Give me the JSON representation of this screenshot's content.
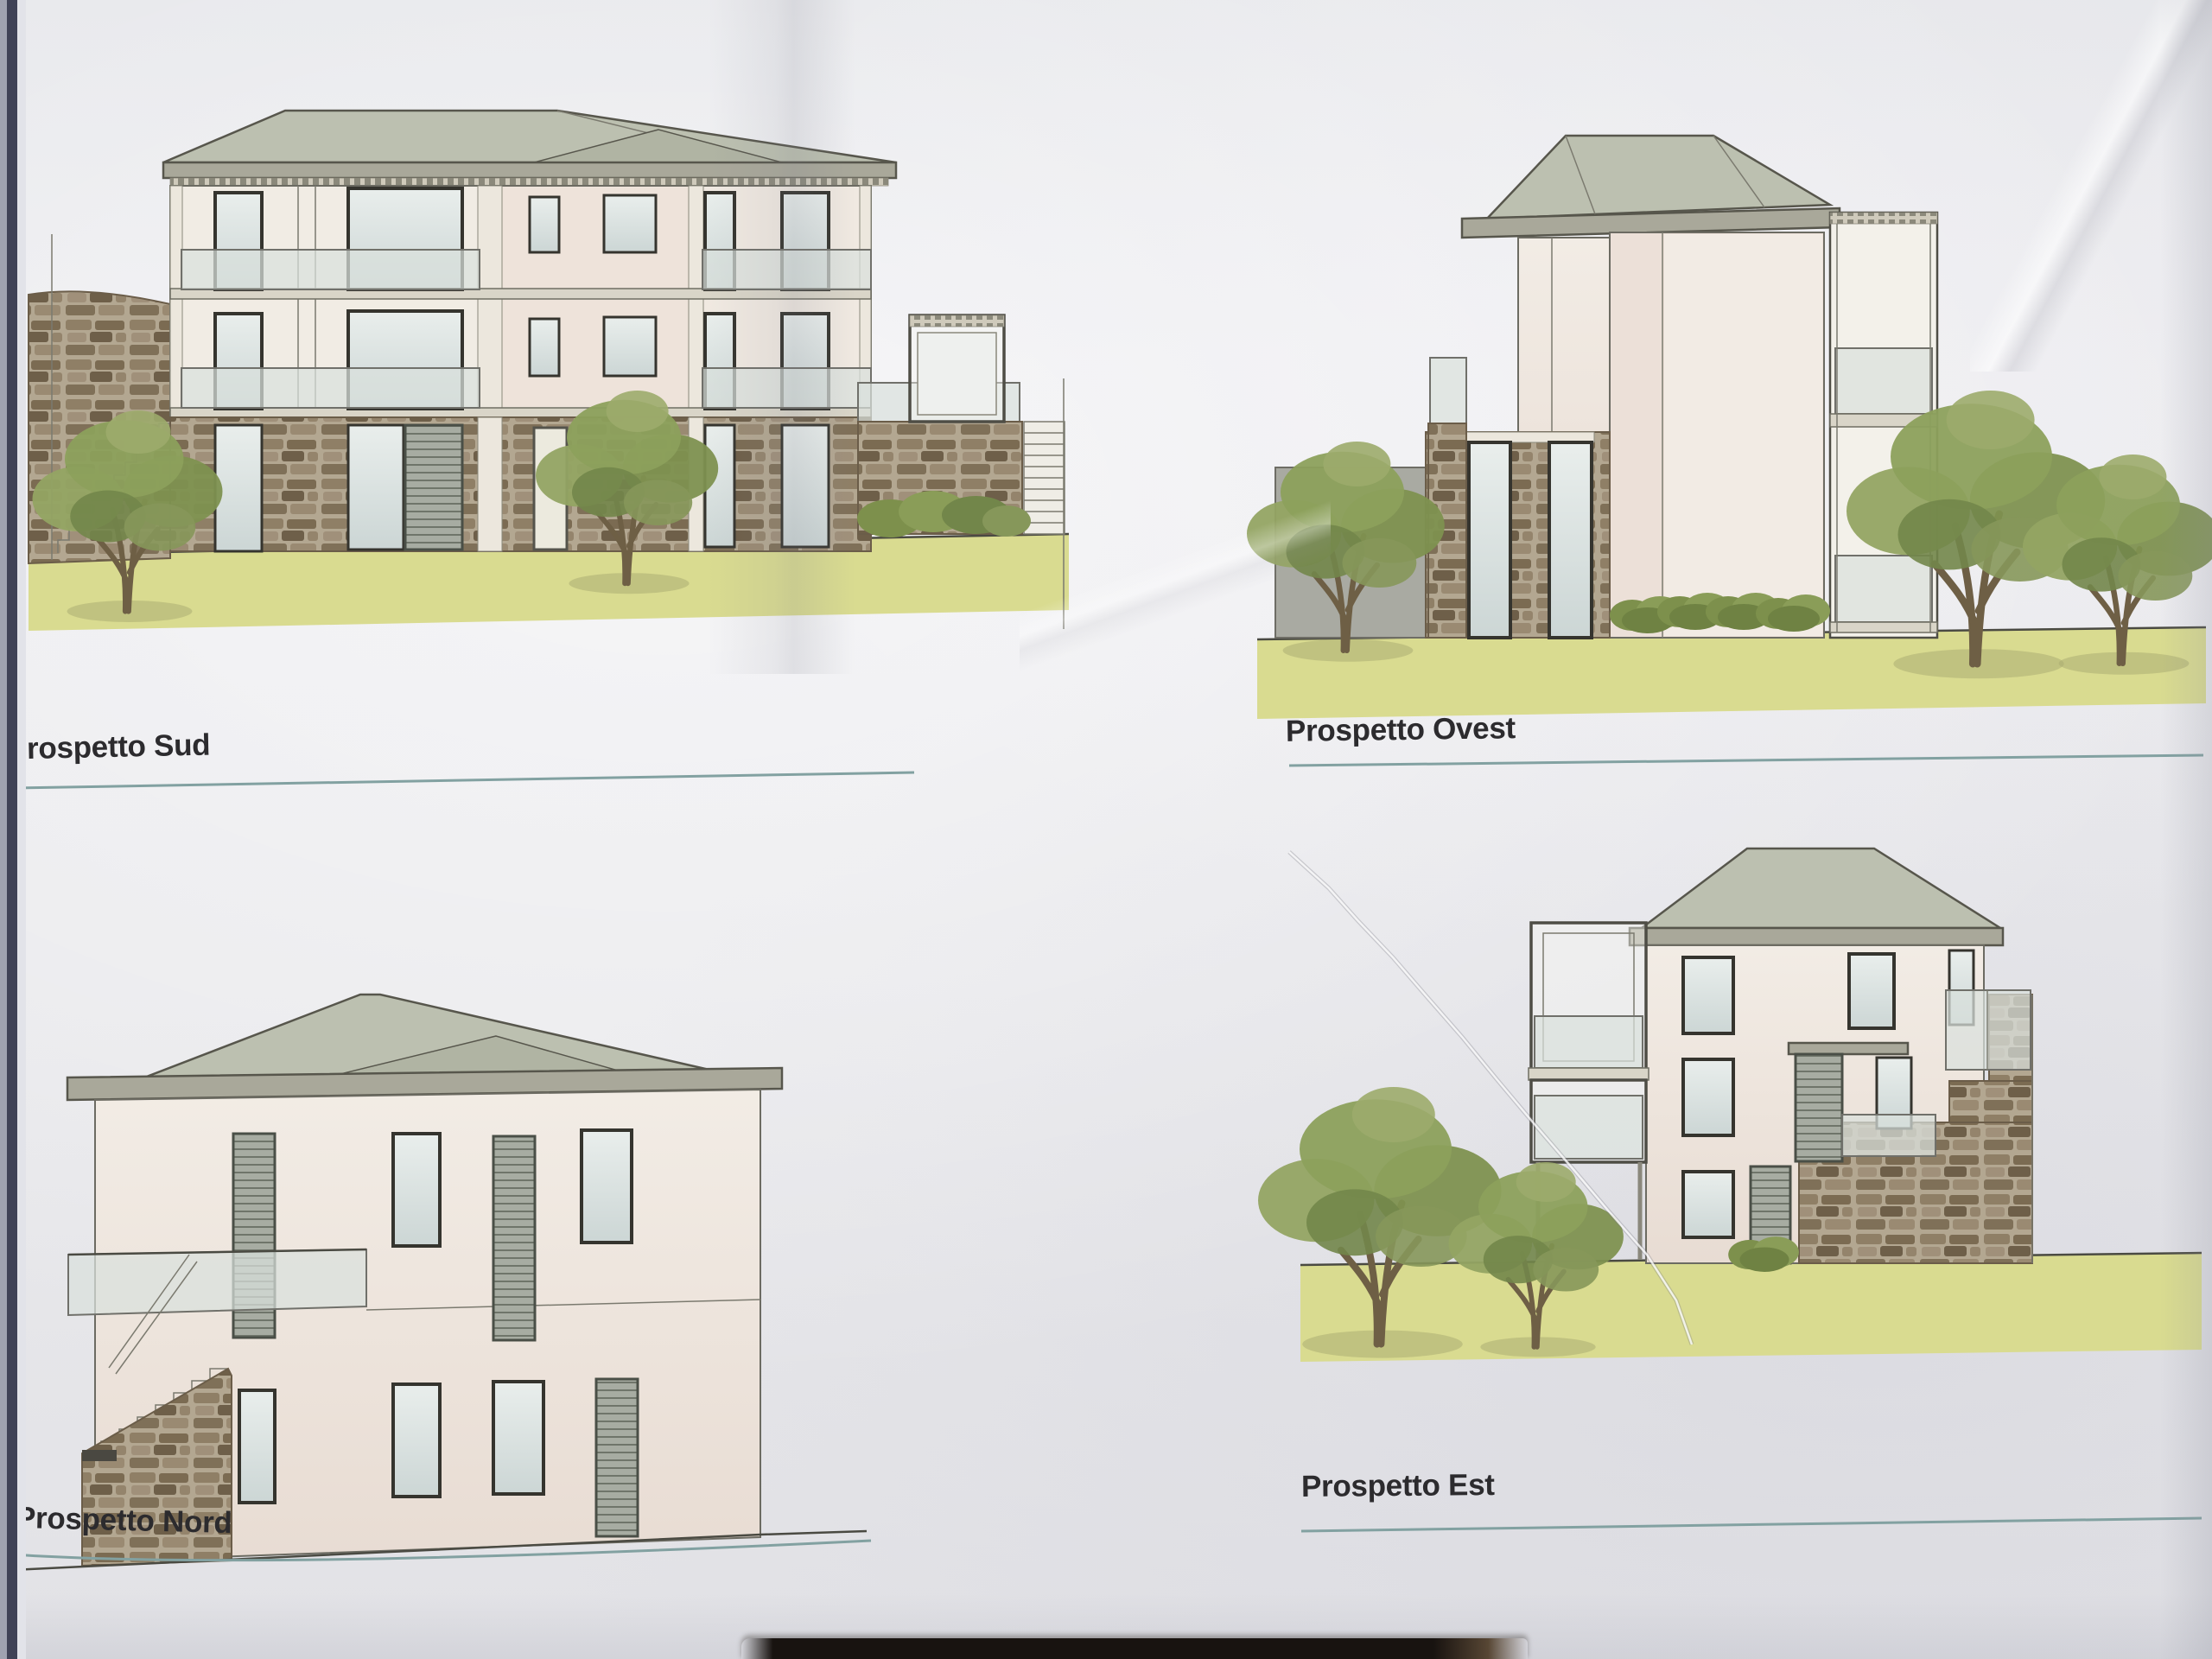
{
  "elevations": [
    {
      "id": "sud",
      "label": "Prospetto Sud"
    },
    {
      "id": "ovest",
      "label": "Prospetto Ovest"
    },
    {
      "id": "nord",
      "label": "Prospetto Nord"
    },
    {
      "id": "est",
      "label": "Prospetto Est"
    }
  ],
  "colors": {
    "paper": "#e9e9ec",
    "label_text": "#2c2b2e",
    "underline": "#82a1a1",
    "roof": "#bcc0b0",
    "eaves_band": "#a9a89a",
    "wall_cream": "#f1ebe4",
    "wall_pink": "#eee3da",
    "window_glass": "#dde6e4",
    "balustrade_glass": "#d9e0dc",
    "stone": "#8f7f66",
    "stone_mortar": "#b3a791",
    "grass": "#d9db90",
    "tree_foliage": "#8a9c58",
    "tree_trunk": "#6e5f45",
    "shutter": "#a7aca2",
    "table_background": "#181310",
    "page_edge": "#3f4256"
  }
}
